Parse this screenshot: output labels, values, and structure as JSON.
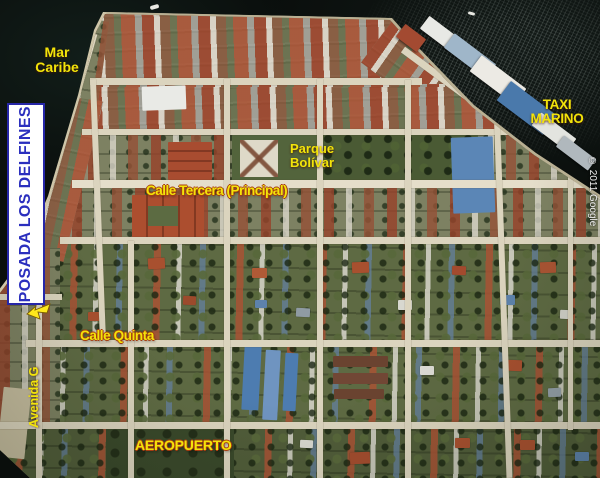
{
  "map": {
    "sea_label": {
      "line1": "Mar",
      "line2": "Caribe"
    },
    "hotel_banner": "POSADA LOS DELFINES",
    "taxi_label": {
      "line1": "TAXI",
      "line2": "MARINO"
    },
    "park_label": {
      "line1": "Parque",
      "line2": "Bolívar"
    },
    "streets": {
      "tercera": "Calle Tercera (Principal)",
      "quinta": "Calle Quinta",
      "avenida": "Avenida G",
      "airport": "AEROPUERTO"
    },
    "credit": "© 2011 Google",
    "colors": {
      "label_yellow": "#f2e40a",
      "label_outline": "#a63c10",
      "hotel_blue": "#2b2fbe",
      "hotel_border": "#2626a8",
      "credit_white": "#efefef",
      "water": "#0a0e0c"
    }
  }
}
